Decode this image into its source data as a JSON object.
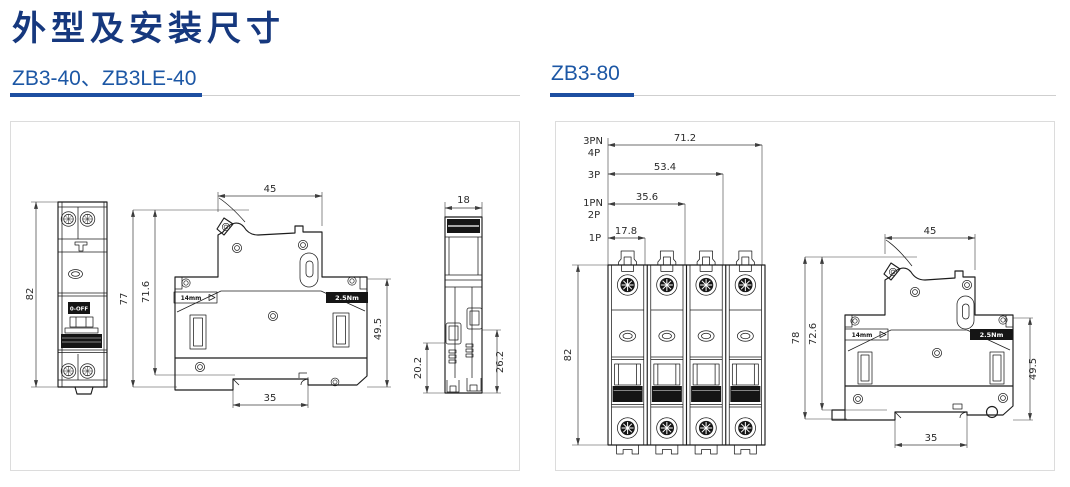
{
  "title": "外型及安装尺寸",
  "colors": {
    "title-color": "#16387E",
    "heading-color": "#1C57A5",
    "accent": "#1D4FA1",
    "rule": "#CFCFCF",
    "panel-border": "#DCDCDC",
    "line": "#1C1C1C",
    "dim": "#3C3C3C"
  },
  "left": {
    "heading": "ZB3-40、ZB3LE-40",
    "front_view": {
      "height": "82",
      "switch_label": "0-OFF"
    },
    "side_view": {
      "top_width": "45",
      "total_height": "77",
      "body_height": "71.6",
      "depth": "49.5",
      "rail_width": "35",
      "gauge_label": "14mm",
      "torque_label": "2.5Nm"
    },
    "top_view": {
      "width": "18",
      "terminal_depth_left": "20.2",
      "terminal_depth_right": "26.2"
    }
  },
  "right": {
    "heading": "ZB3-80",
    "pole_widths": [
      {
        "pole": "3PN",
        "pole_alt": "4P",
        "width": "71.2"
      },
      {
        "pole": "3P",
        "width": "53.4"
      },
      {
        "pole": "1PN",
        "pole_alt": "2P",
        "width": "35.6"
      },
      {
        "pole": "1P",
        "width": "17.8"
      }
    ],
    "front_view": {
      "height": "82"
    },
    "side_view": {
      "top_width": "45",
      "total_height": "78",
      "body_height": "72.6",
      "depth": "49.5",
      "rail_width": "35",
      "gauge_label": "14mm",
      "torque_label": "2.5Nm"
    }
  }
}
